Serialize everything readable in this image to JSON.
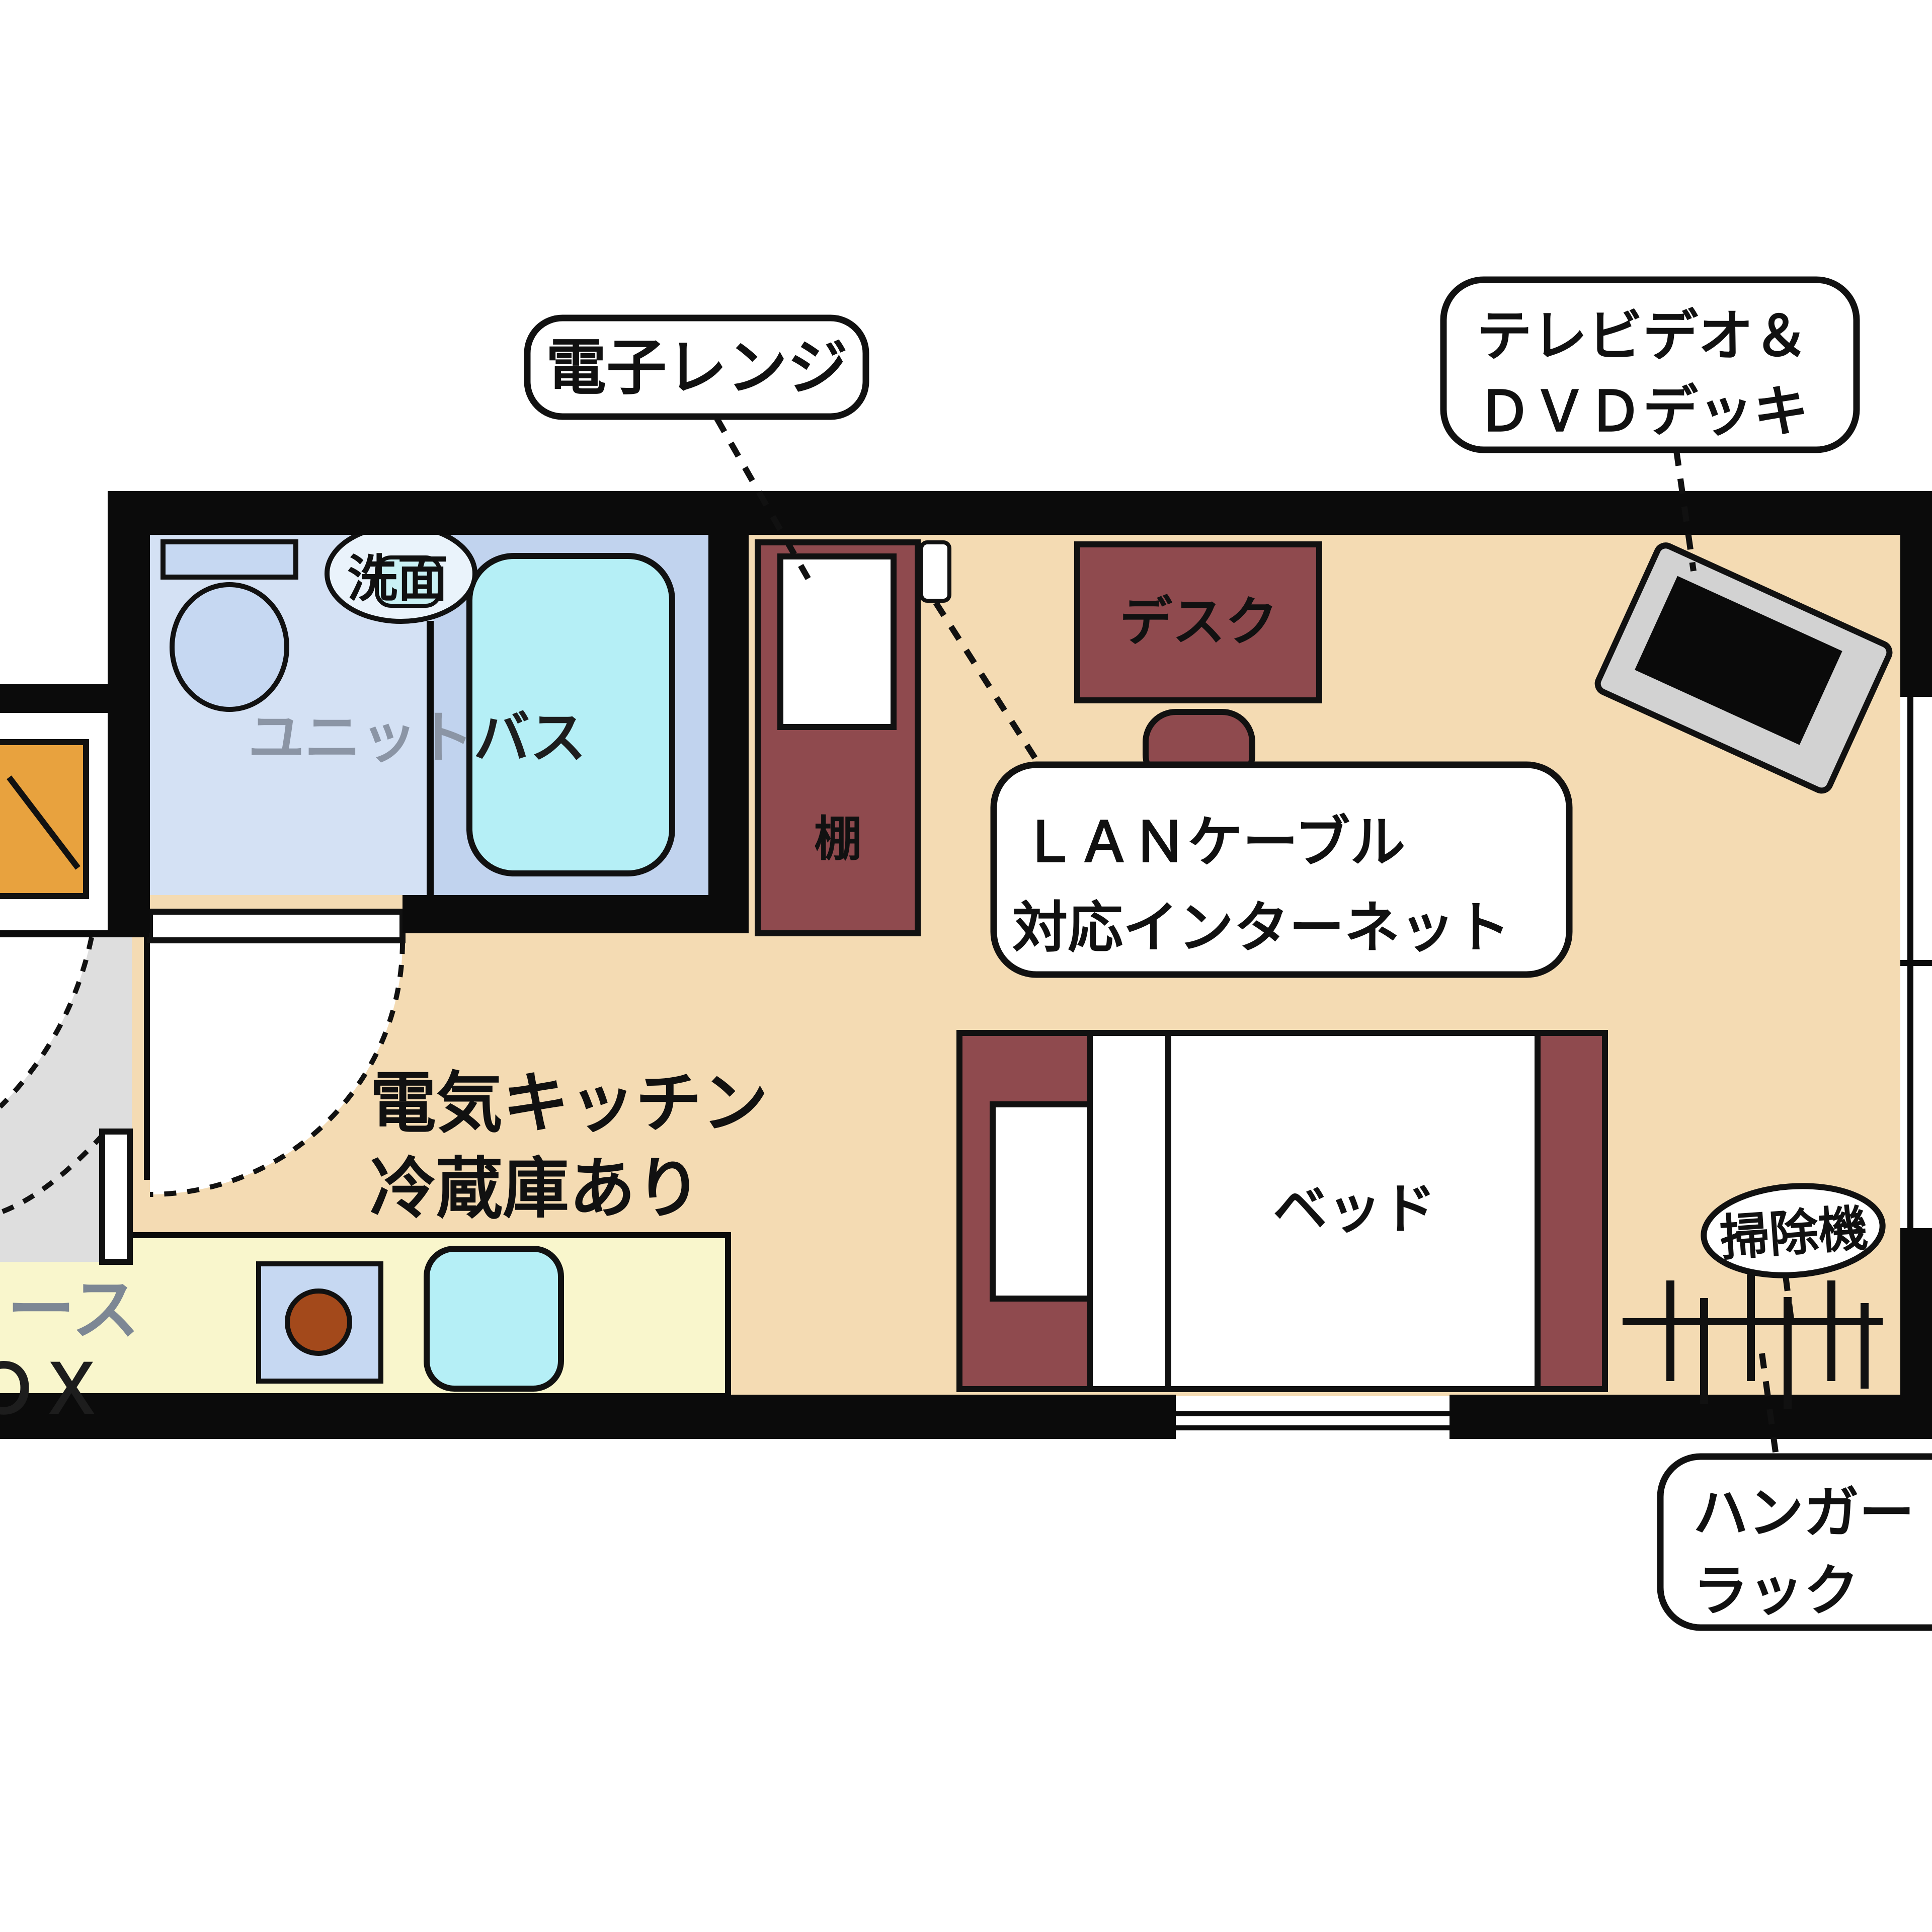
{
  "diagram": {
    "type": "floor-plan",
    "title": "ワンルーム間取り図",
    "labels": {
      "microwave": "電子レンジ",
      "tv_video_line1": "テレビデオ＆",
      "tv_video_line2": "ＤＶＤデッキ",
      "lan_line1": "ＬＡＮケーブル",
      "lan_line2": "対応インターネット",
      "unit_bath_part1": "ユニット",
      "unit_bath_part2": "バス",
      "washbasin": "洗面",
      "shelf": "棚",
      "desk": "デスク",
      "bed": "ベッド",
      "kitchen_line1": "電気キッチン",
      "kitchen_line2": "冷蔵庫あり",
      "vacuum_cleaner": "掃除機",
      "hanger_rack_line1": "ハンガー",
      "hanger_rack_line2": "ラック",
      "cutoff_text_line1": "ース",
      "cutoff_text_line2": "ＯＸ"
    },
    "colors": {
      "wall": "#0b0b0b",
      "main_floor": "#f4dbb3",
      "kitchen_floor": "#f9f6cc",
      "bathroom_floor": "#d4e1f4",
      "bath_panel": "#c1d3ee",
      "entry_floor": "#dedede",
      "bathtub": "#b5eff6",
      "furniture_maroon": "#8f4a4e",
      "tv_body": "#d2d2d2",
      "entry_step_orange": "#e8a23e",
      "burner_brown": "#a3491b"
    }
  }
}
